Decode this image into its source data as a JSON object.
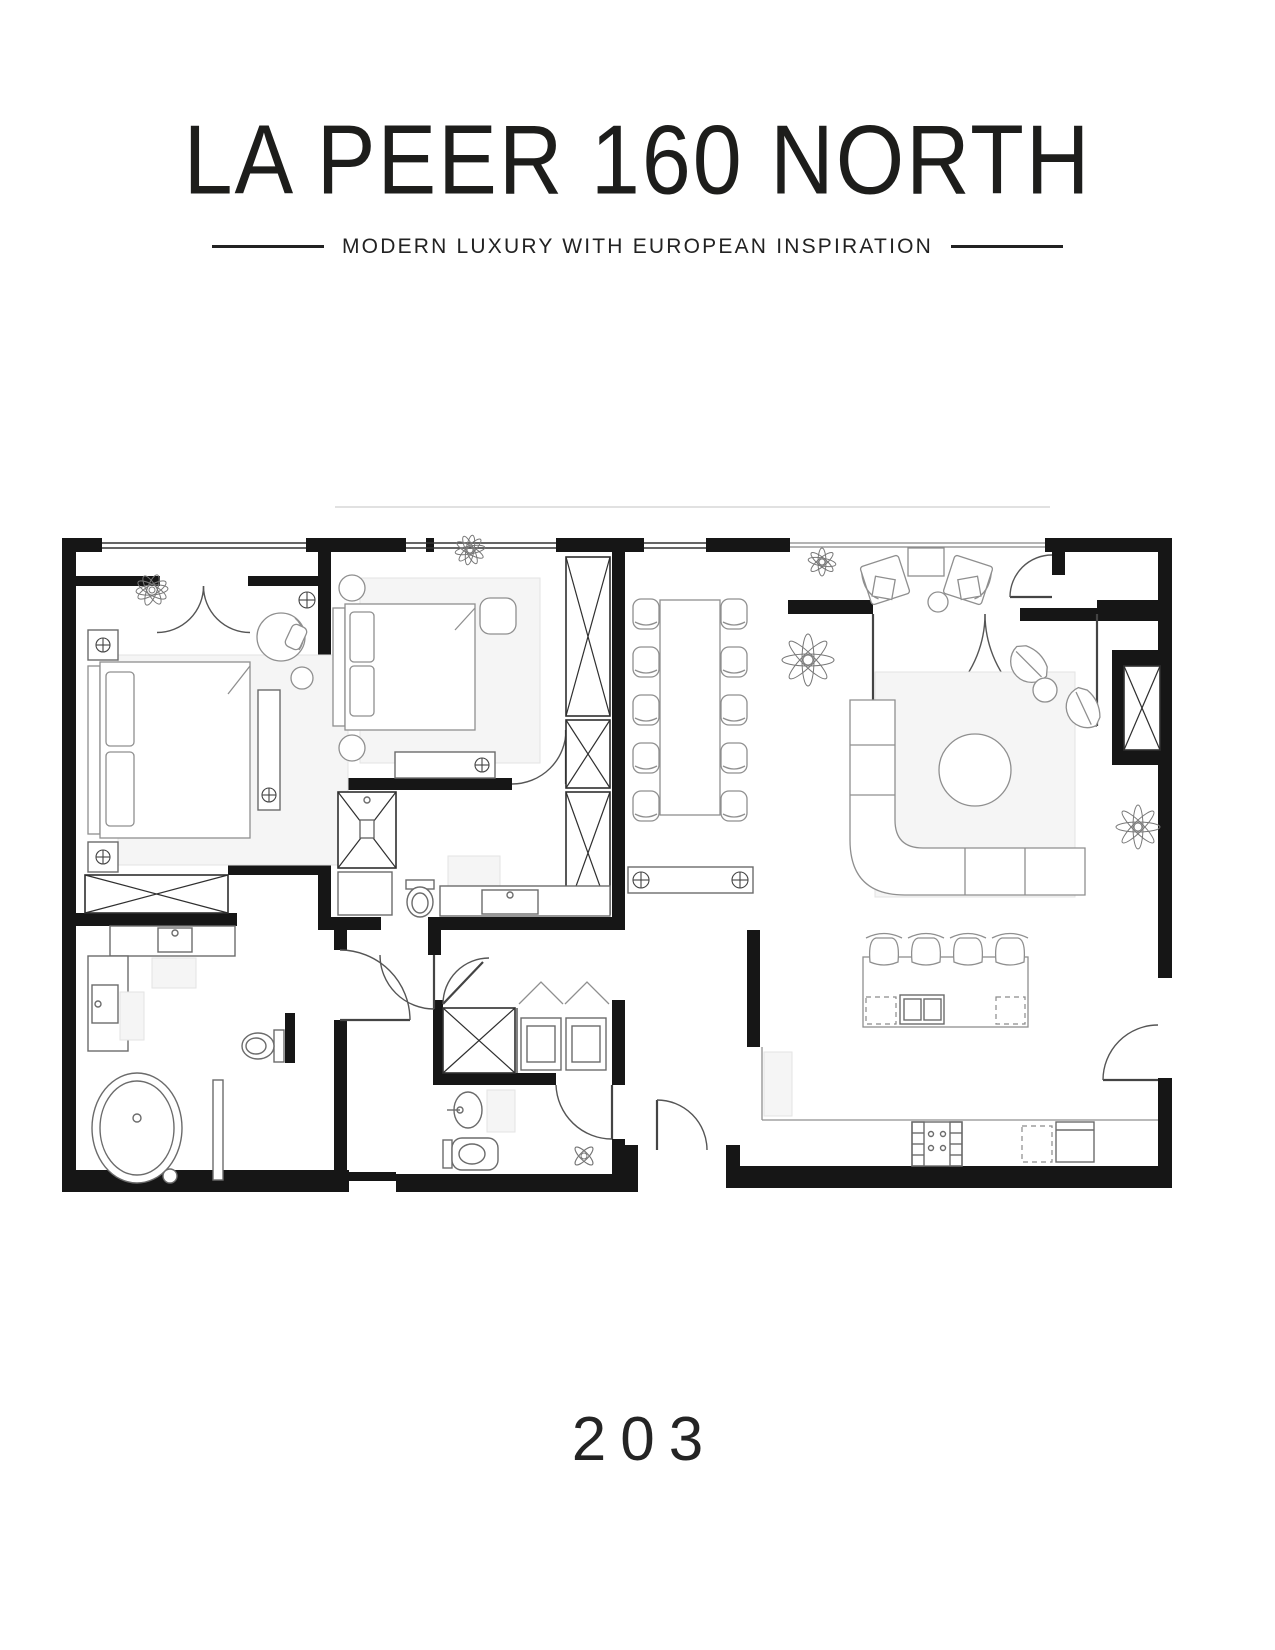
{
  "page": {
    "background": "#ffffff"
  },
  "header": {
    "title": "LA PEER 160 NORTH",
    "tagline": "MODERN LUXURY WITH EUROPEAN INSPIRATION"
  },
  "unit": {
    "number": "203"
  },
  "plan": {
    "wall_color": "#161616",
    "furniture_stroke": "#8f8f8f",
    "light_fill": "#f5f5f5",
    "rooms": [
      "primary-bedroom",
      "bedroom-2",
      "primary-bathroom",
      "bathroom-2",
      "powder-room",
      "walk-in-closet",
      "laundry-closet",
      "hallway",
      "dining-area",
      "living-room",
      "kitchen",
      "balcony",
      "storage-room"
    ],
    "furniture": [
      "king-bed",
      "queen-bed",
      "nightstands",
      "armchair",
      "dining-table-10-chairs",
      "console-table",
      "sectional-sofa",
      "round-coffee-table",
      "accent-chairs",
      "kitchen-island-4-stools",
      "range",
      "dishwasher",
      "freestanding-tub",
      "double-vanity",
      "toilets",
      "shower",
      "washer-dryer",
      "wardrobes",
      "balcony-lounge-chairs",
      "plants"
    ]
  }
}
